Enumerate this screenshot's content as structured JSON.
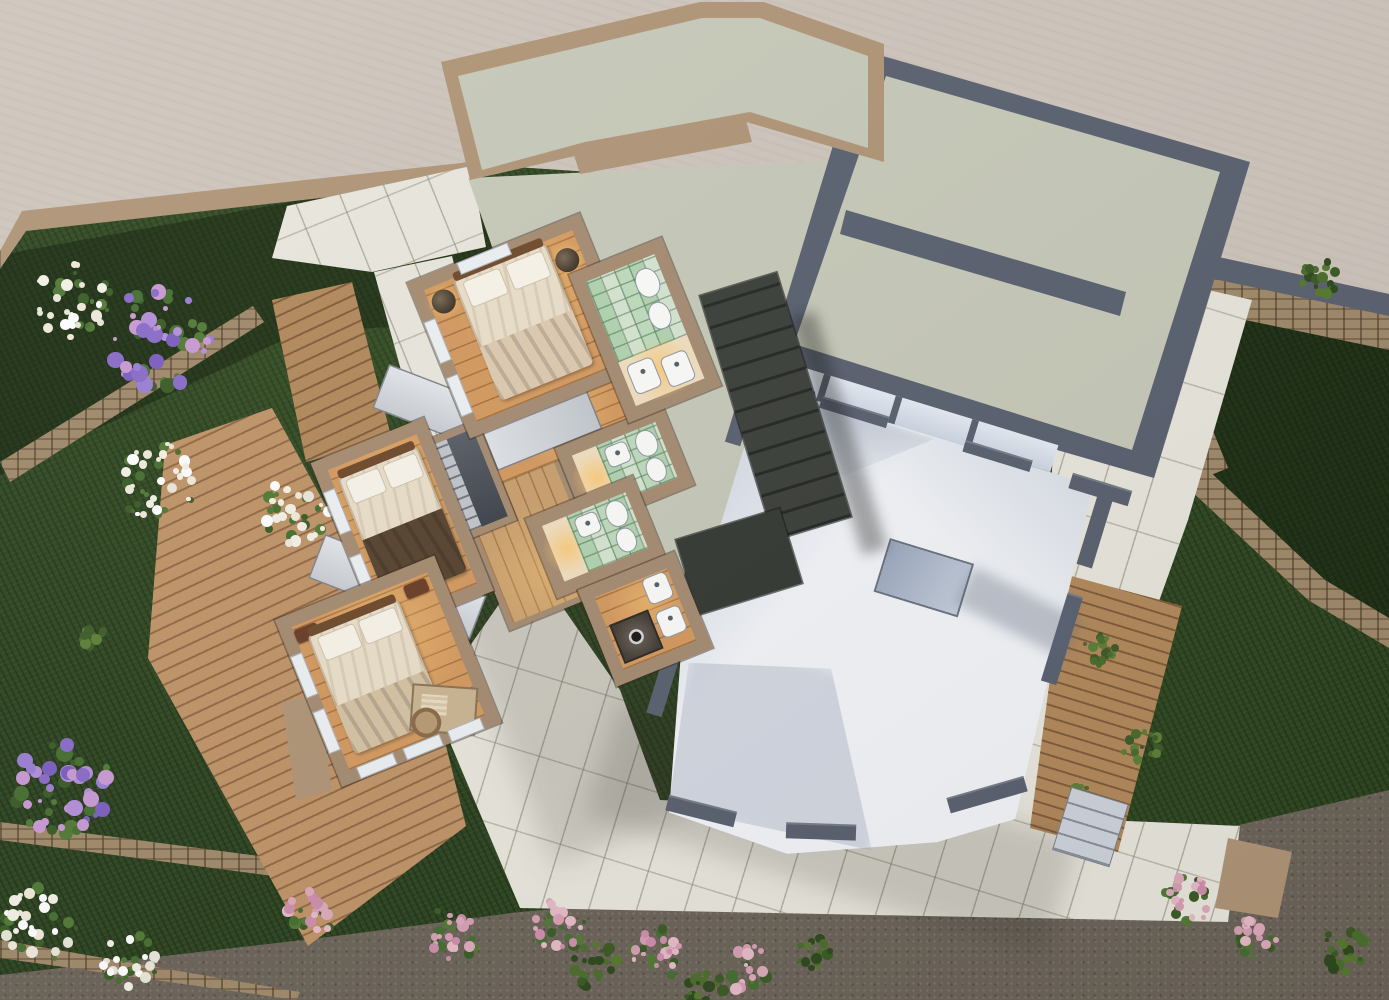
{
  "meta": {
    "title": "Aerial 3D floor plan rendering",
    "view": "top-down",
    "visible_text": "none"
  },
  "palette": {
    "groundBeige": "#cfc6bd",
    "lawn": "#2c4220",
    "gravel": "#6c6459",
    "paver": "#e9e7dd",
    "deck": "#b3895c",
    "deckLight": "#c09468",
    "stone": "#a18a6b",
    "wallTan": "#a68c72",
    "parapetTan": "#b09577",
    "slate": "#5a6170",
    "roofSage": "#c7c9b9",
    "roofStair": "#3c403a",
    "whiteFloor": "#f3f5f9",
    "woodFloor": "#d49a60",
    "corridorWood": "#caa06e",
    "tileGreen": "#cfe0c8",
    "cream": "#f1dfc0",
    "bedCream": "#eadfca",
    "pillow": "#f8f4ea",
    "throwDark": "#57432f",
    "throwLight": "#d6c3a4",
    "headboard": "#6f4a2b",
    "nightstand": "#6b3e27",
    "fixture": "#fbfbf9",
    "graySlab": "#c9cdd3",
    "stairLight": "#c2c6cc",
    "stairDark": "#3f434b",
    "window": "#eef1f4",
    "flora": {
      "hydrangea": [
        "#7b5fc0",
        "#9a7fd4",
        "#b48fd9",
        "#c99ad4",
        "#8a6cc8"
      ],
      "daisy": [
        "#f4f1e6",
        "#e9e6da",
        "#ffffff",
        "#efeadb"
      ],
      "pink": [
        "#d9a0b5",
        "#cf8fae",
        "#e7bcc9",
        "#deaabc"
      ],
      "shrub": [
        "#3c5a26",
        "#4c6e2e",
        "#2f4a1e",
        "#567a2e"
      ],
      "vine": [
        "#4a6c2f",
        "#5c8038",
        "#3e5c28"
      ],
      "leaf": [
        "#466f30",
        "#3a5c26",
        "#527a36"
      ]
    }
  },
  "scene": {
    "ground_regions": [
      "upper-plateau-beige",
      "lawn",
      "hedge-beds",
      "gravel-path",
      "paver-terraces",
      "wood-decks",
      "stone-retaining-walls"
    ],
    "building": {
      "bedroom_wing": {
        "rotation_deg": -22,
        "rooms": [
          "master-bedroom",
          "master-bathroom",
          "landing",
          "staircase",
          "bedroom-2",
          "corridor",
          "bathroom-2",
          "bathroom-3",
          "shower-room",
          "bedroom-3"
        ]
      },
      "living_wing": {
        "rotation_deg": 17,
        "elements": [
          "flat-roof-upper",
          "flat-roof-lower",
          "clerestory-windows",
          "double-height-white-floor",
          "roof-stair",
          "skylight-box",
          "exterior-steps"
        ]
      }
    },
    "furniture": {
      "beds": 3,
      "toilets": 3,
      "bidets": 3,
      "sinks": 6,
      "showers": 2,
      "desks": 1,
      "wardrobes": 2
    },
    "vegetation": {
      "clusters": [
        {
          "type": "daisy",
          "x": 72,
          "y": 300,
          "r": 42
        },
        {
          "type": "hydrangea",
          "x": 158,
          "y": 338,
          "r": 56
        },
        {
          "type": "daisy",
          "x": 160,
          "y": 485,
          "r": 46
        },
        {
          "type": "daisy",
          "x": 298,
          "y": 512,
          "r": 38
        },
        {
          "type": "hydrangea",
          "x": 62,
          "y": 786,
          "r": 54
        },
        {
          "type": "daisy",
          "x": 40,
          "y": 925,
          "r": 40
        },
        {
          "type": "daisy",
          "x": 130,
          "y": 962,
          "r": 30
        },
        {
          "type": "pink",
          "x": 310,
          "y": 915,
          "r": 26
        },
        {
          "type": "pink",
          "x": 450,
          "y": 935,
          "r": 30
        },
        {
          "type": "pink",
          "x": 560,
          "y": 925,
          "r": 28
        },
        {
          "type": "pink",
          "x": 660,
          "y": 952,
          "r": 30
        },
        {
          "type": "pink",
          "x": 745,
          "y": 968,
          "r": 26
        },
        {
          "type": "shrub",
          "x": 595,
          "y": 965,
          "r": 26
        },
        {
          "type": "shrub",
          "x": 705,
          "y": 988,
          "r": 22
        },
        {
          "type": "shrub",
          "x": 815,
          "y": 955,
          "r": 20
        },
        {
          "type": "shrub",
          "x": 1320,
          "y": 278,
          "r": 20
        },
        {
          "type": "pink",
          "x": 1190,
          "y": 900,
          "r": 30
        },
        {
          "type": "pink",
          "x": 1255,
          "y": 938,
          "r": 24
        },
        {
          "type": "vine",
          "x": 1100,
          "y": 650,
          "r": 18
        },
        {
          "type": "vine",
          "x": 1142,
          "y": 748,
          "r": 20
        },
        {
          "type": "vine",
          "x": 1082,
          "y": 800,
          "r": 16
        },
        {
          "type": "vine",
          "x": 95,
          "y": 640,
          "r": 14
        },
        {
          "type": "shrub",
          "x": 1345,
          "y": 950,
          "r": 26
        }
      ]
    }
  }
}
